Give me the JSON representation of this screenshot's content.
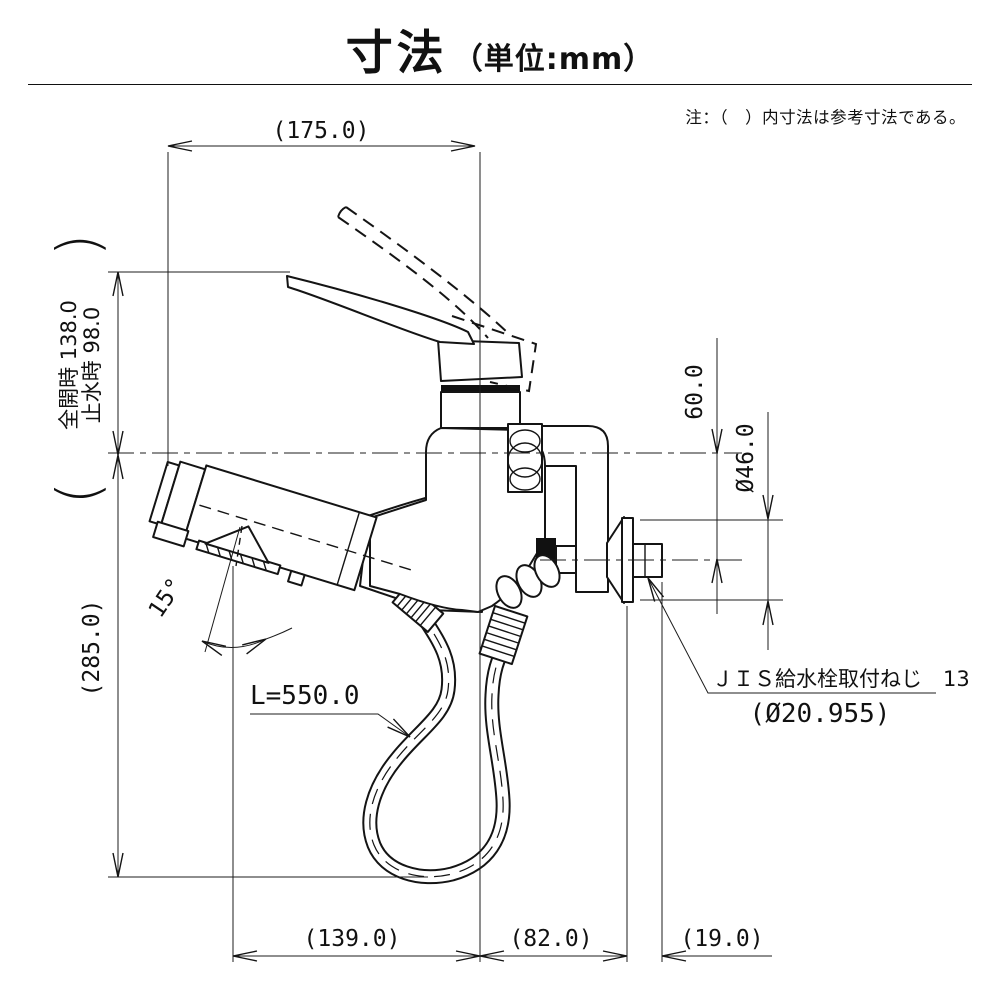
{
  "title": {
    "main": "寸法",
    "unit": "（単位:mm）"
  },
  "note": "注：（　）内寸法は参考寸法である。",
  "dimensions": {
    "top_width": "(175.0)",
    "handle_full_open_label": "全開時 138.0",
    "handle_closed_label": "止水時 98.0",
    "paren_open": "(",
    "paren_close": ")",
    "height_total": "(285.0)",
    "wall_offset": "60.0",
    "flange_diameter": "Ø46.0",
    "spray_angle": "15°",
    "hose_length": "L=550.0",
    "spout_reach": "(139.0)",
    "body_to_wall": "(82.0)",
    "thread_length": "(19.0)",
    "thread_note_line1": "ＪＩＳ給水栓取付ねじ　13",
    "thread_note_line2": "(Ø20.955)"
  },
  "colors": {
    "line": "#141414",
    "background": "#ffffff",
    "packing_fill": "#111111"
  }
}
